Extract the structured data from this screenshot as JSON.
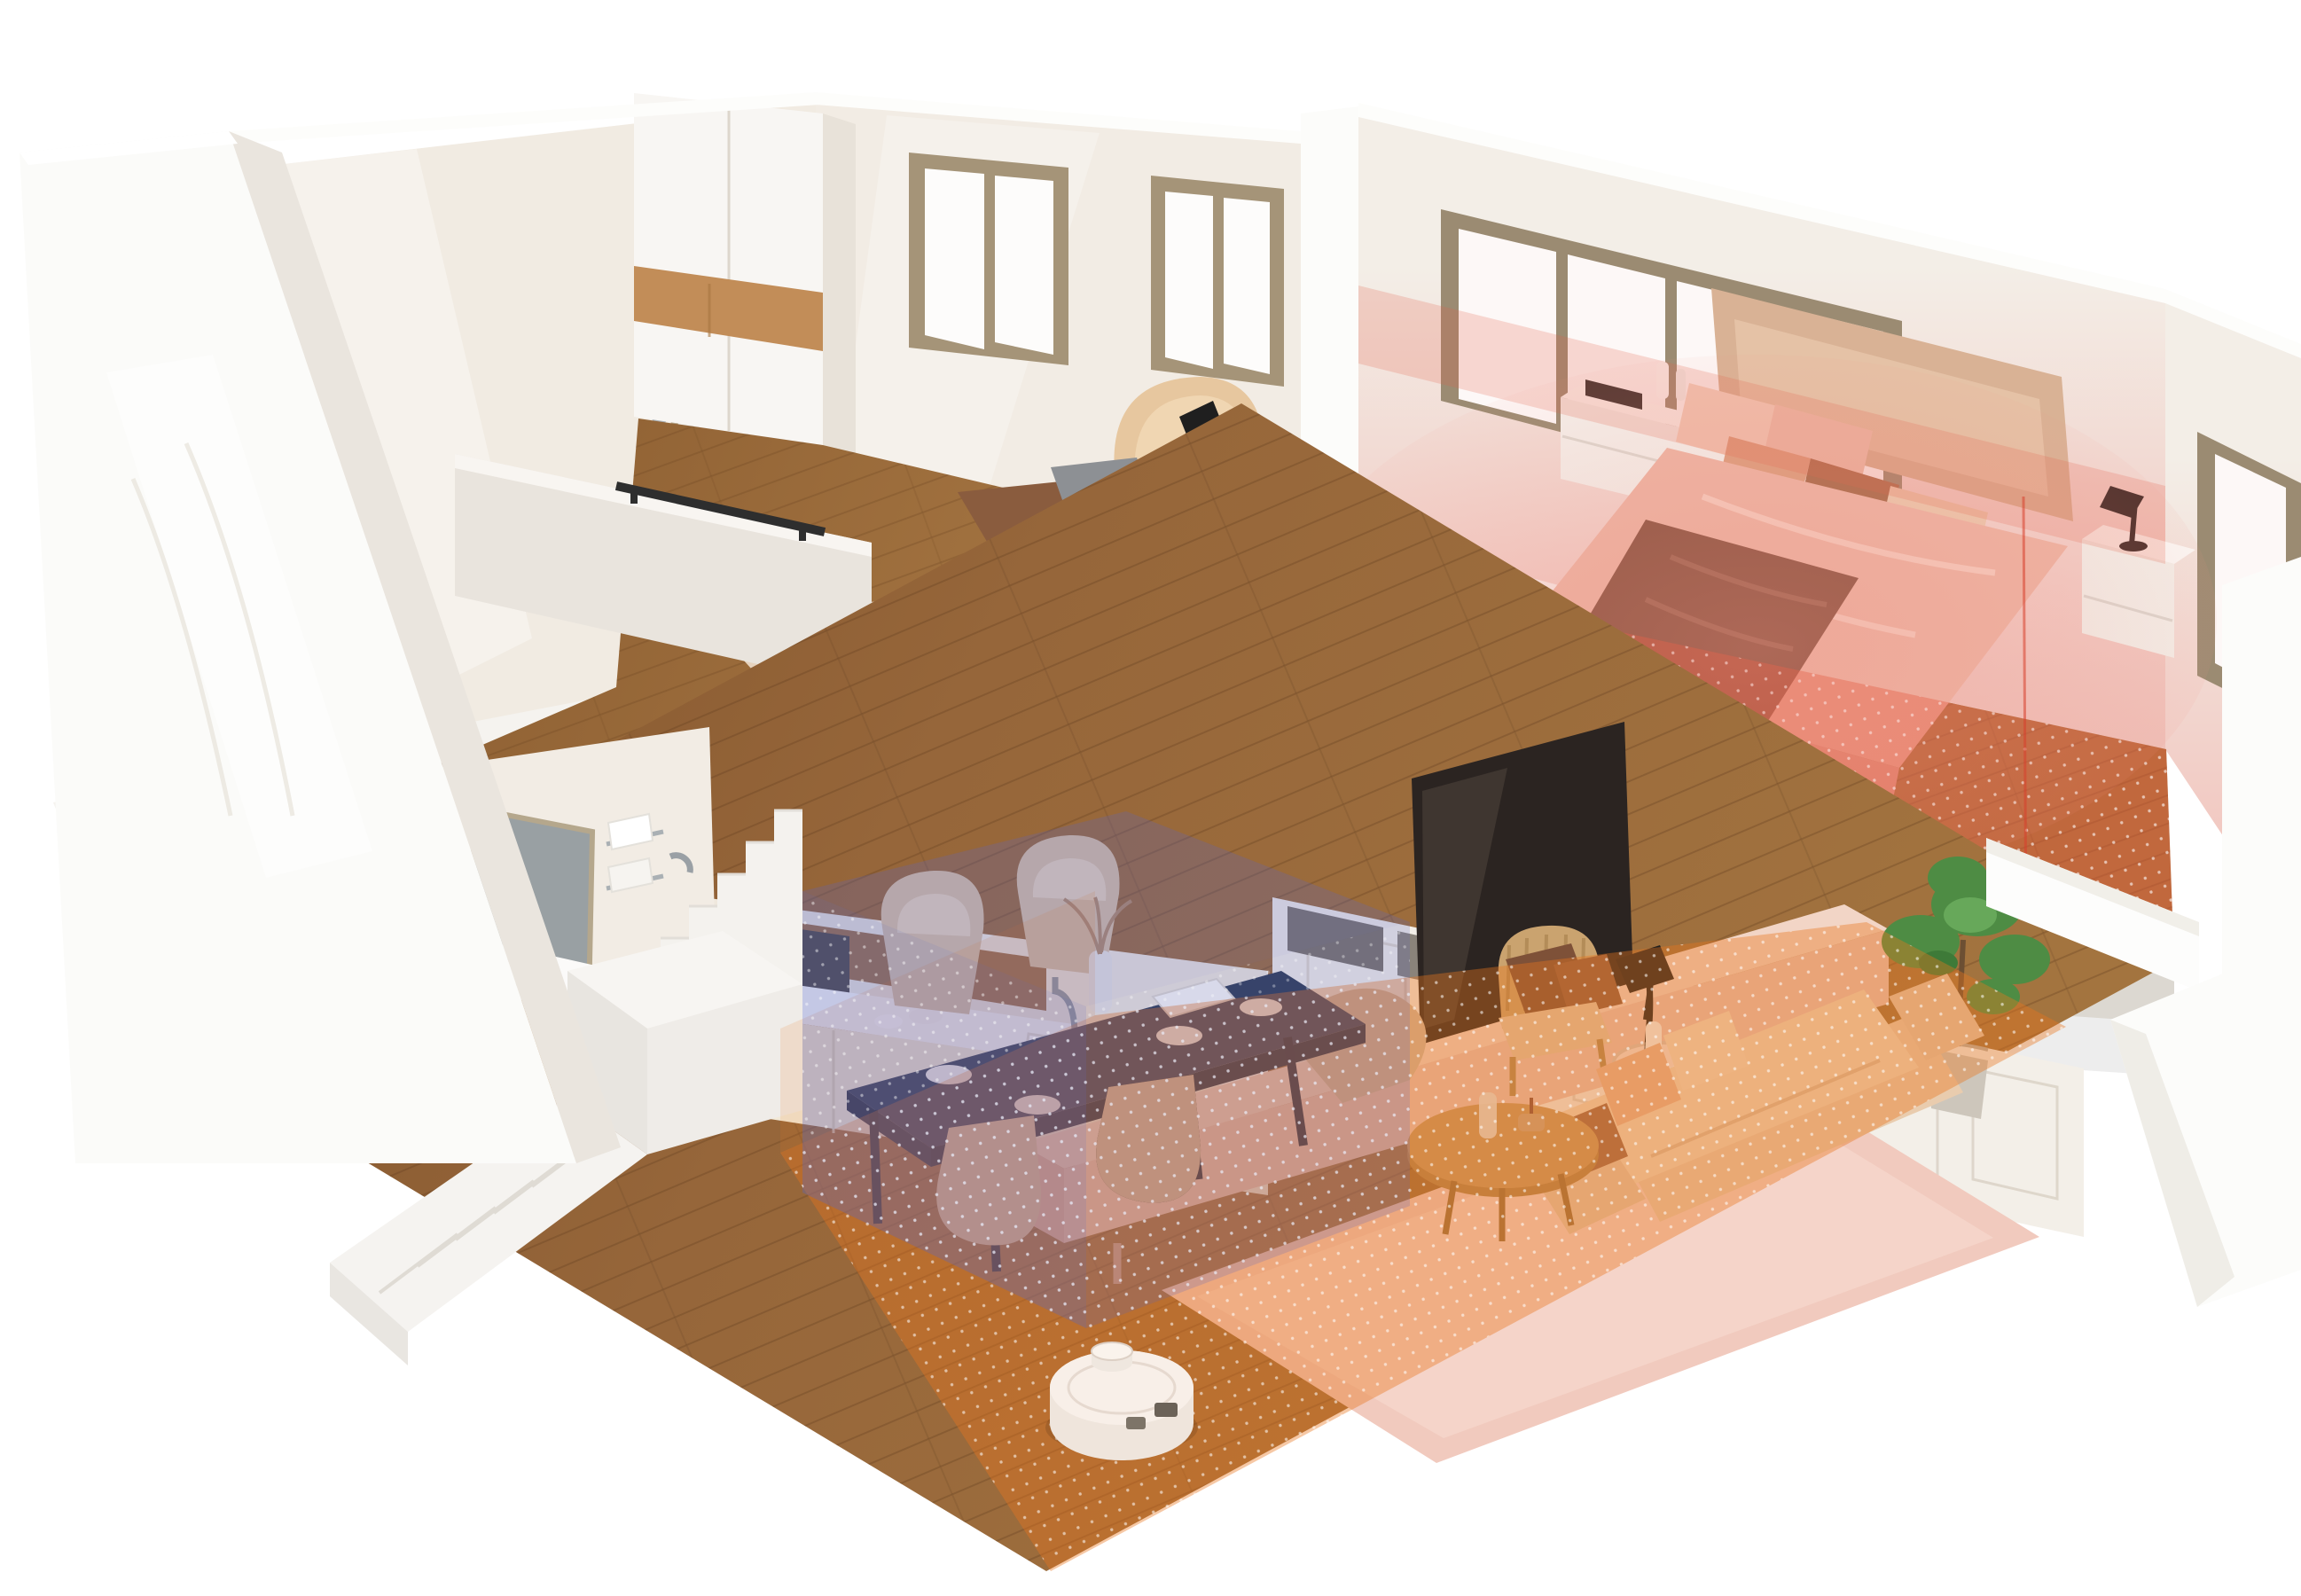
{
  "scene": {
    "title": "Two-story home cutaway showing robot vacuums cleaning mapped zones",
    "type": "isometric dollhouse render",
    "floors": [
      {
        "name": "upper-floor",
        "rooms": [
          "bathroom",
          "home-office",
          "bedroom",
          "hallway-walkway"
        ]
      },
      {
        "name": "ground-floor",
        "rooms": [
          "bathroom",
          "staircase",
          "kitchen",
          "dining-area",
          "living-room"
        ]
      }
    ]
  },
  "zones": [
    {
      "id": "bedroom-zone",
      "label": "Bedroom cleaning zone (red)",
      "color": "#df4f33",
      "wall_tint": "#f3c5be",
      "ceiling_tint": "#e2604a"
    },
    {
      "id": "dining-zone",
      "label": "Dining area cleaning zone (blue)",
      "color": "#5b66c0"
    },
    {
      "id": "living-zone",
      "label": "Living room cleaning zone (orange)",
      "color": "#e9761f"
    }
  ],
  "robots": [
    {
      "id": "robot-vacuum-upper",
      "label": "Robot vacuum on upper floor walkway"
    },
    {
      "id": "robot-vacuum-lower",
      "label": "Robot vacuum in living room"
    }
  ],
  "palette": {
    "wall_white": "#fbfbf9",
    "wall_cream": "#f2ecE4",
    "wood_floor_lower": "#91halt",
    "wood_lower": "#8f5e31",
    "wood_upper": "#a0703d",
    "wood_cabinet": "#b5854f",
    "walnut_desk": "#77492e",
    "slab_gray": "#dcd8d1",
    "navy_table": "#2d3950",
    "sofa_beige": "#ecd0b3",
    "rug_pink": "#f0c8bc",
    "tv_dark": "#2b2421",
    "plant_green": "#4e8c44",
    "robot_body": "#f6f3ef",
    "frame_tan": "#a08e70"
  }
}
